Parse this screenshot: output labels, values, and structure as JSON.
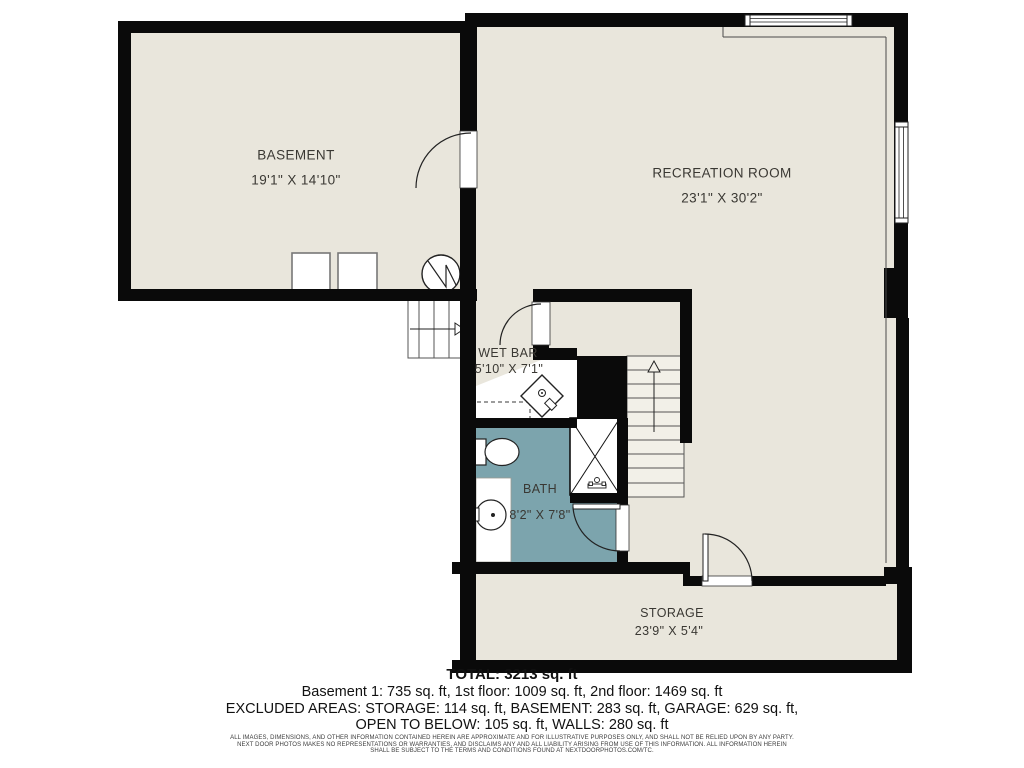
{
  "plan": {
    "rooms": [
      {
        "id": "basement",
        "label": "BASEMENT",
        "dims": "19'1\" X 14'10\""
      },
      {
        "id": "recreation-room",
        "label": "RECREATION ROOM",
        "dims": "23'1\" X 30'2\""
      },
      {
        "id": "wet-bar",
        "label": "WET BAR",
        "dims": "5'10\" X 7'1\""
      },
      {
        "id": "bath",
        "label": "BATH",
        "dims": "8'2\" X 7'8\""
      },
      {
        "id": "storage",
        "label": "STORAGE",
        "dims": "23'9\" X 5'4\""
      }
    ],
    "colors": {
      "floor": "#e9e6dc",
      "wall": "#0a0a0a",
      "bath_floor": "#7ca4ad",
      "thin_line": "#4a4a4a"
    }
  },
  "summary": {
    "total": "TOTAL: 3213 sq. ft",
    "floors": "Basement 1: 735 sq. ft, 1st floor: 1009 sq. ft, 2nd floor: 1469 sq. ft",
    "excluded": "EXCLUDED AREAS: STORAGE: 114 sq. ft, BASEMENT: 283 sq. ft, GARAGE: 629 sq. ft,",
    "excluded2": "OPEN TO BELOW: 105 sq. ft, WALLS: 280 sq. ft"
  },
  "disclaimer": {
    "line1": "ALL IMAGES, DIMENSIONS, AND OTHER INFORMATION CONTAINED HEREIN ARE APPROXIMATE AND FOR ILLUSTRATIVE PURPOSES ONLY, AND SHALL NOT BE RELIED UPON BY ANY PARTY.",
    "line2": "NEXT DOOR PHOTOS MAKES NO REPRESENTATIONS OR WARRANTIES, AND DISCLAIMS ANY AND ALL LIABILITY ARISING FROM USE OF THIS INFORMATION. ALL INFORMATION HEREIN",
    "line3": "SHALL BE SUBJECT TO THE TERMS AND CONDITIONS FOUND AT NEXTDOORPHOTOS.COM/TC."
  }
}
